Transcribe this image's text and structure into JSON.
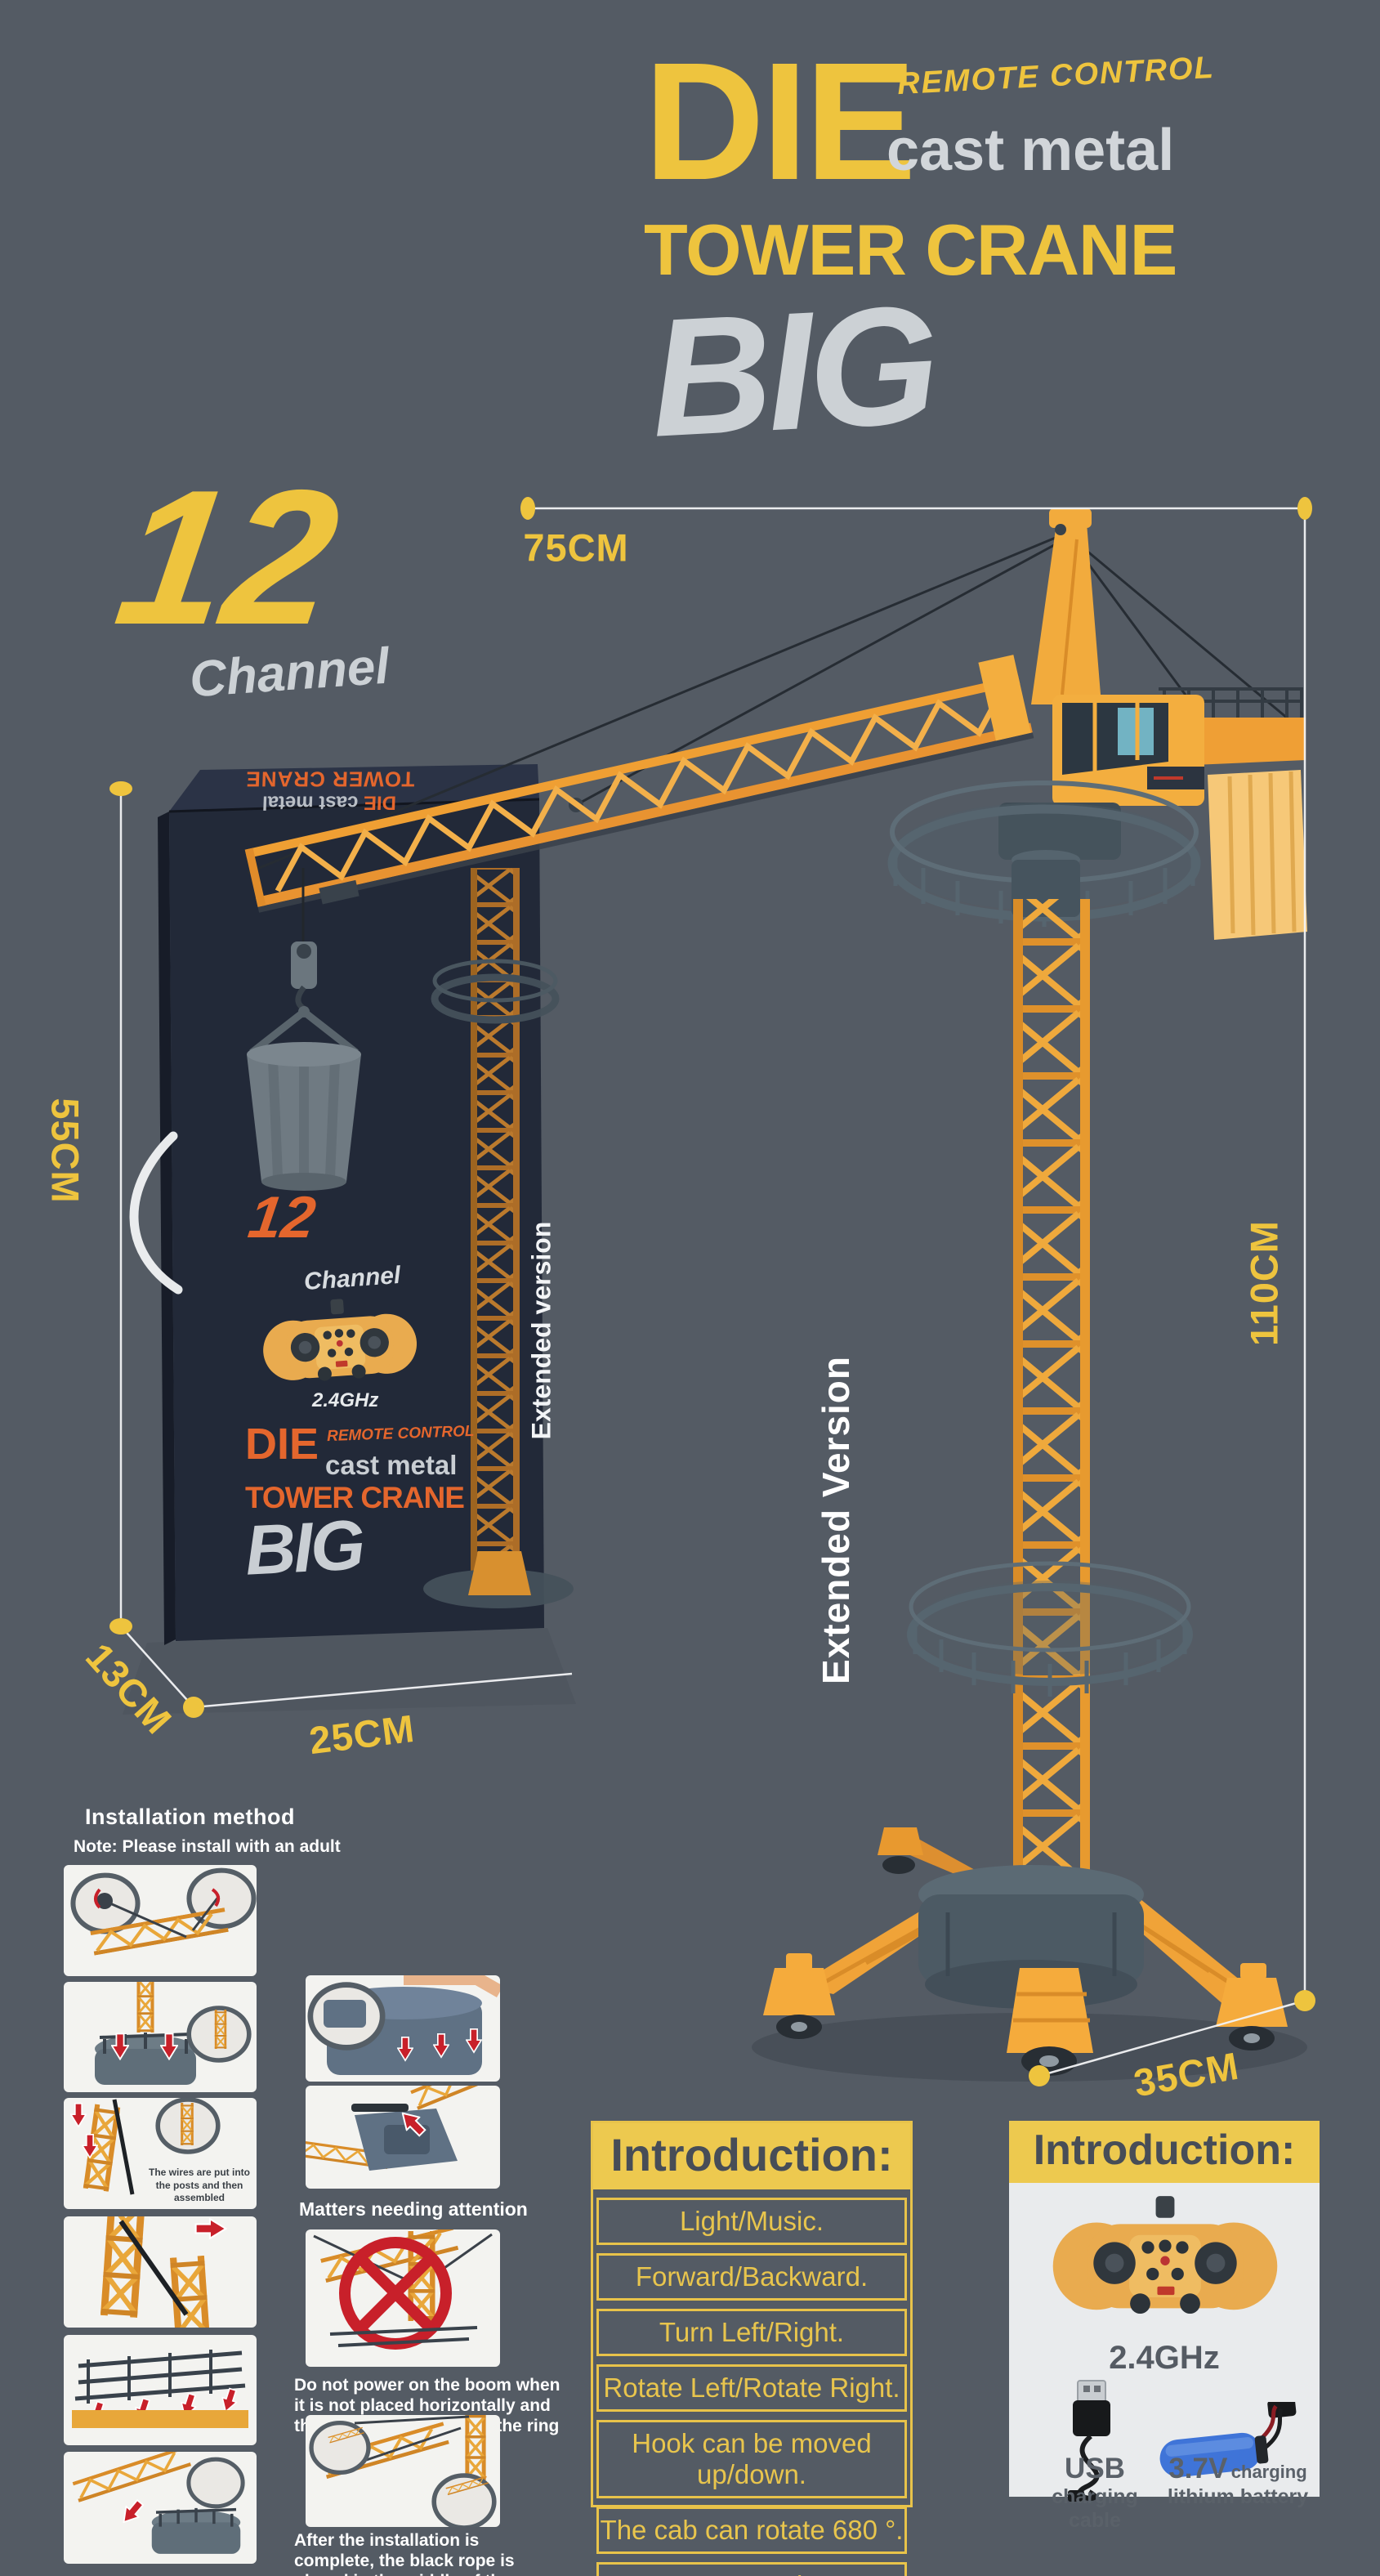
{
  "colors": {
    "background": "#545b64",
    "accent_yellow": "#eec43e",
    "accent_orange": "#e4662d",
    "box_navy": "#222938",
    "warning_red": "#c8202a",
    "crane_orange": "#f2a93e",
    "slate_gray": "#5a6872",
    "light_text": "#d2d6da",
    "white": "#ffffff"
  },
  "title": {
    "die": "DIE",
    "remote_control": "REMOTE CONTROL",
    "cast_metal": "cast metal",
    "tower_crane": "TOWER CRANE",
    "big": "BIG"
  },
  "channel_logo": {
    "number": "12",
    "label": "Channel"
  },
  "dimensions": {
    "jib_length": "75CM",
    "box_height": "55CM",
    "box_depth": "13CM",
    "box_width": "25CM",
    "crane_height": "110CM",
    "base_width": "35CM"
  },
  "extended_version_large": "Extended Version",
  "box": {
    "top_die": "DIE",
    "top_cast": "cast metal",
    "top_tower": "TOWER CRANE",
    "channel_number": "12",
    "channel_label": "Channel",
    "frequency": "2.4GHz",
    "die": "DIE",
    "remote_control": "REMOTE CONTROL",
    "cast_metal": "cast metal",
    "tower_crane": "TOWER CRANE",
    "big": "BIG",
    "extended": "Extended version"
  },
  "installation": {
    "heading": "Installation method",
    "note": "Note: Please install with an adult",
    "wires_caption": "The wires are put into the posts and then assembled",
    "matters_heading": "Matters needing attention",
    "warning": "Do not power on the boom when it is not placed horizontally and the tie is not fastened to the ring",
    "after_note": "After the installation is complete, the black rope is placed in the middle of the wheel to carry out power operation"
  },
  "intro_functions": {
    "header": "Introduction:",
    "items": [
      "Light/Music.",
      "Forward/Backward.",
      "Turn Left/Right.",
      "Rotate Left/Rotate Right.",
      "Hook can be moved up/down.",
      "The cab can rotate 680 °.",
      "Programming demonstration."
    ]
  },
  "intro_accessories": {
    "header": "Introduction:",
    "frequency": "2.4GHz",
    "usb_big": "USB",
    "usb_small": "charging cable",
    "battery_big": "3.7V",
    "battery_mid": "charging",
    "battery_small": "lithium battery"
  }
}
